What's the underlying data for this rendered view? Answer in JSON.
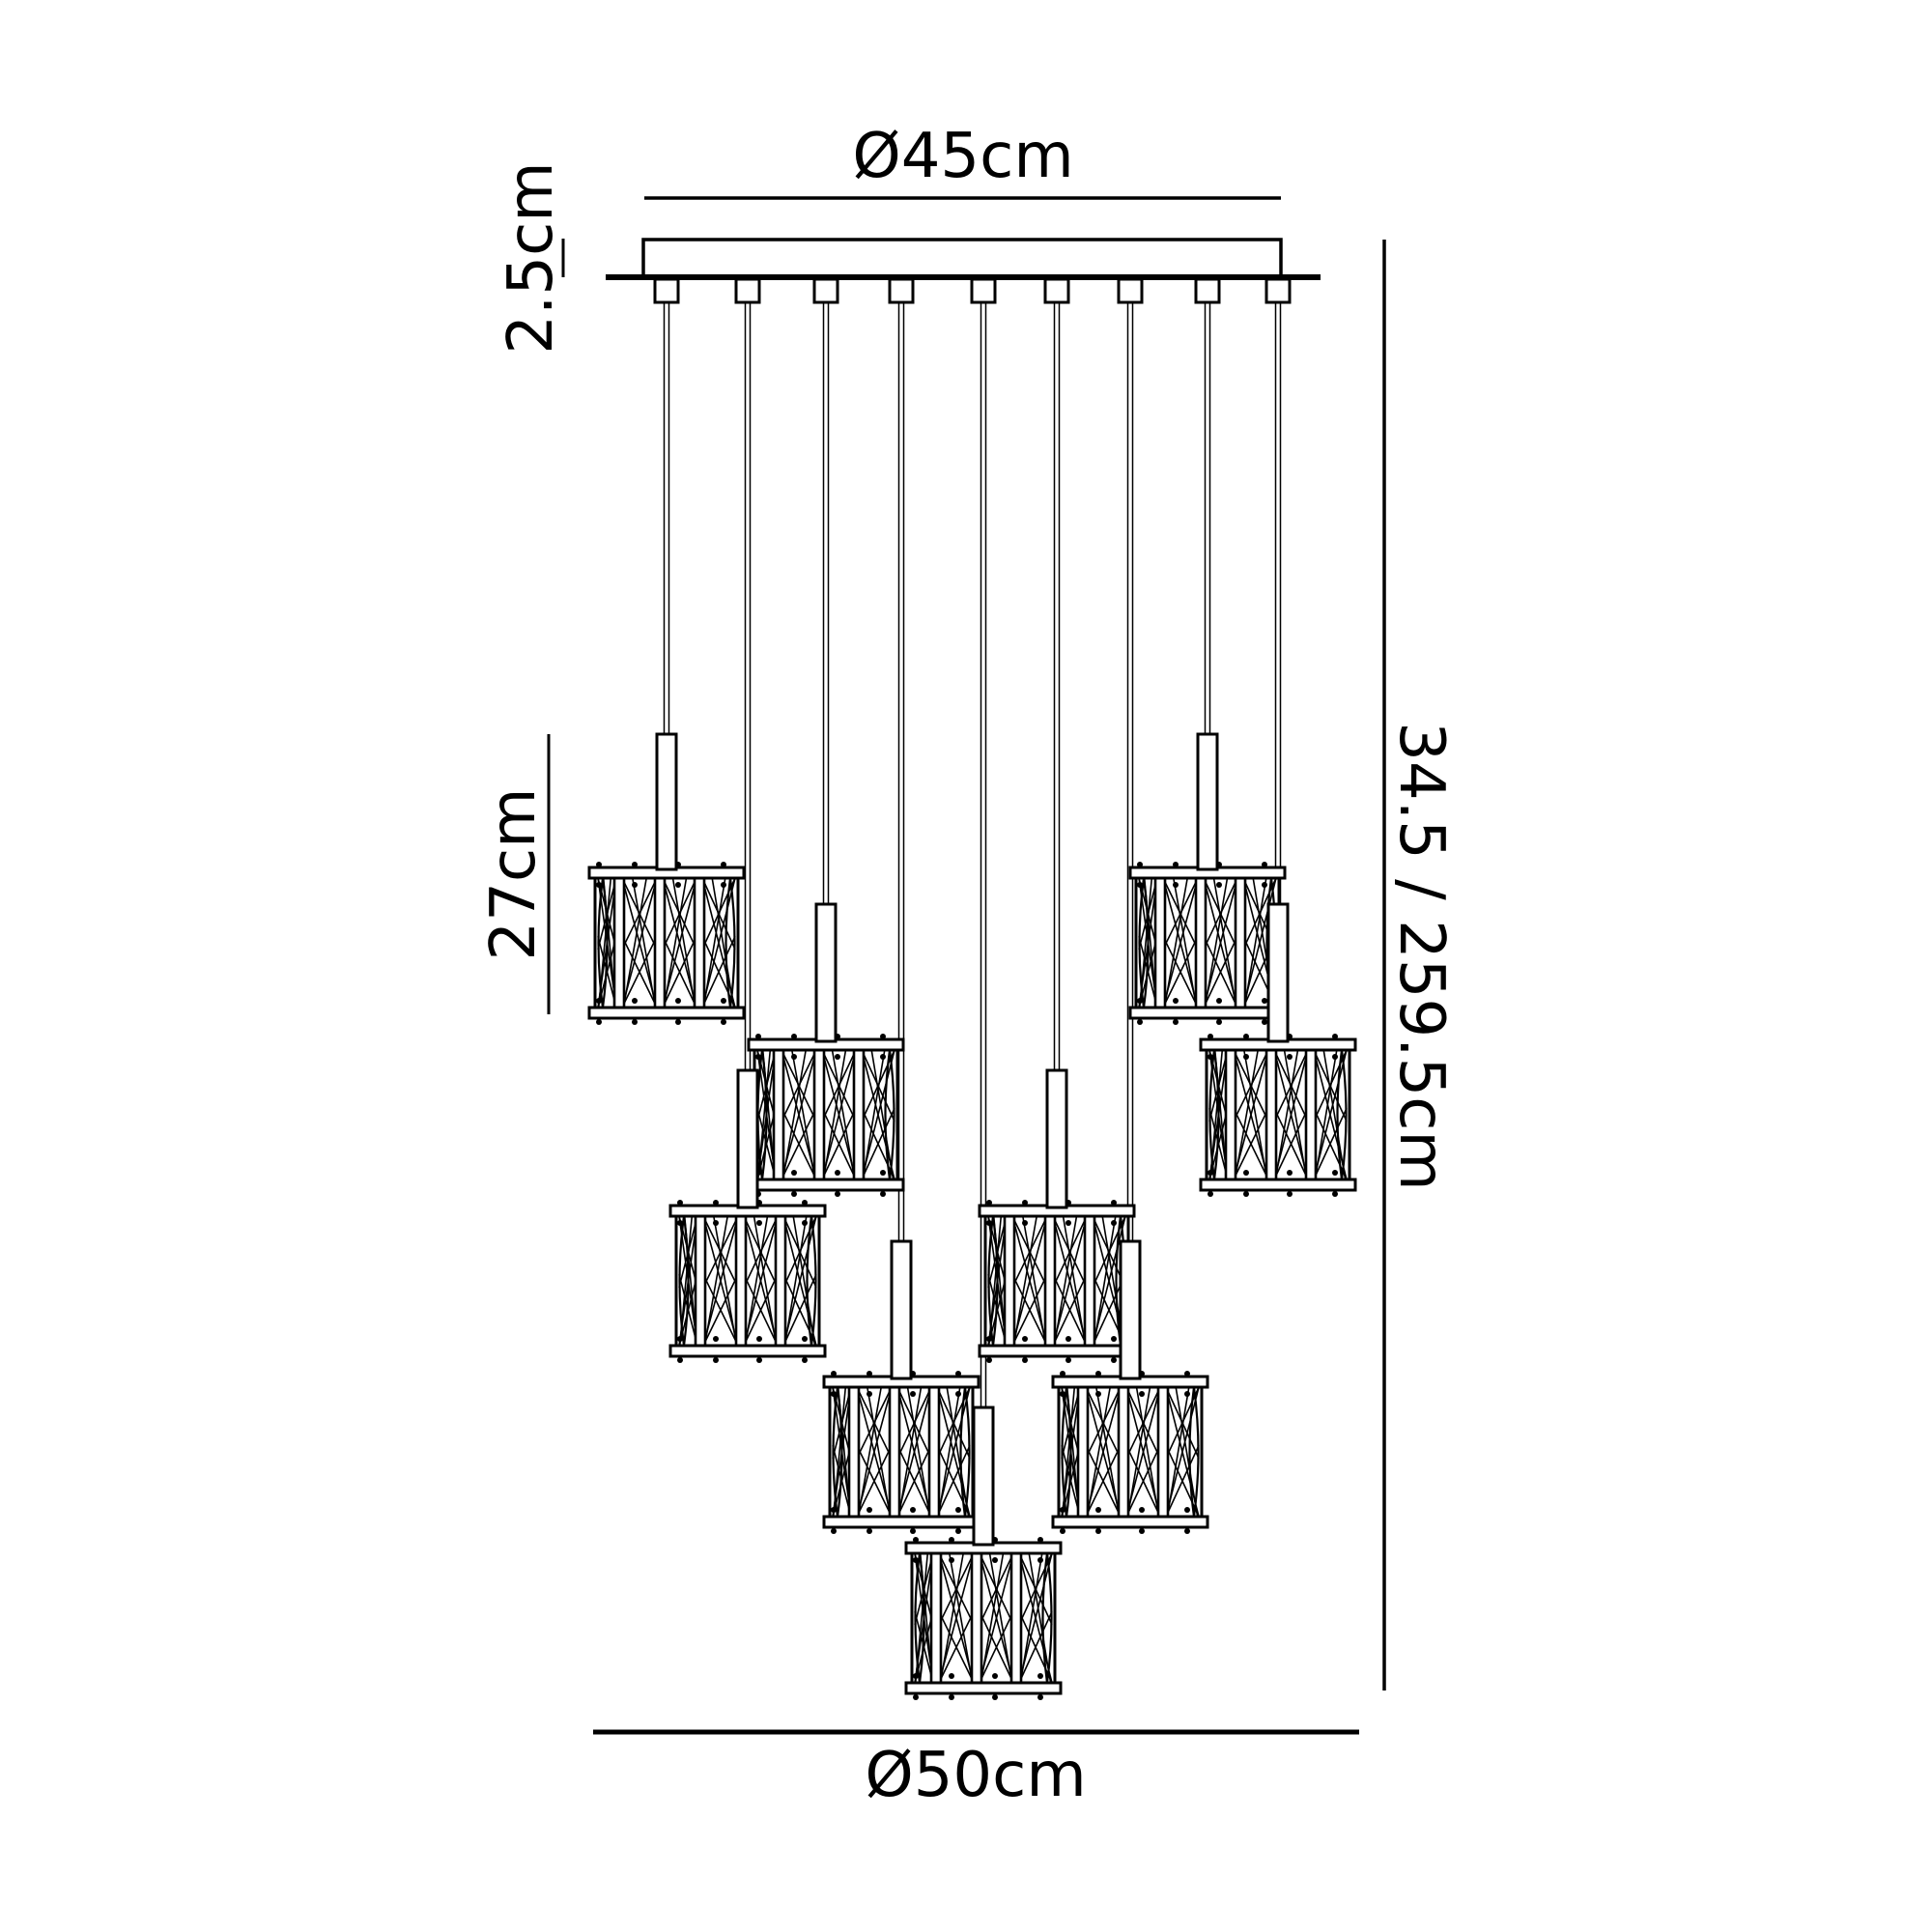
{
  "labels": {
    "plate_diameter": "Ø45cm",
    "plate_thickness": "2.5cm",
    "pendant_height": "27cm",
    "total_drop": "34.5 / 259.5cm",
    "spread_diameter": "Ø50cm"
  },
  "figure": {
    "pendant_count": 9,
    "cord_count": 9,
    "line_color": "#000000",
    "background_color": "#ffffff"
  }
}
